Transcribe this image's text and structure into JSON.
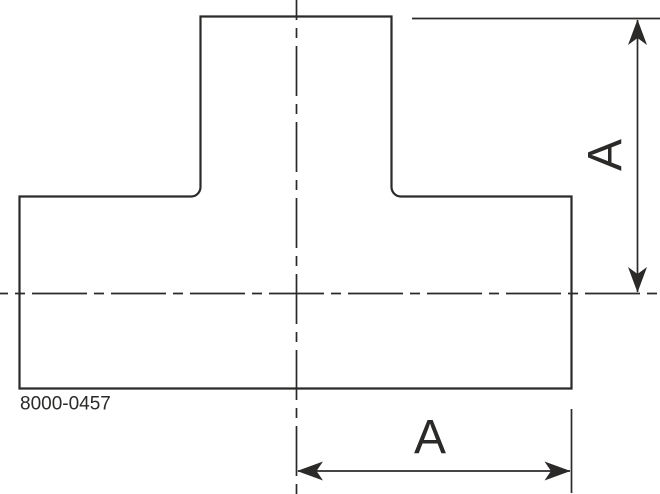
{
  "colors": {
    "background": "#ffffff",
    "line": "#2b2a29"
  },
  "drawing": {
    "part_number": "8000-0457",
    "dimensions": {
      "vertical": {
        "label": "A"
      },
      "horizontal": {
        "label": "A"
      }
    }
  }
}
